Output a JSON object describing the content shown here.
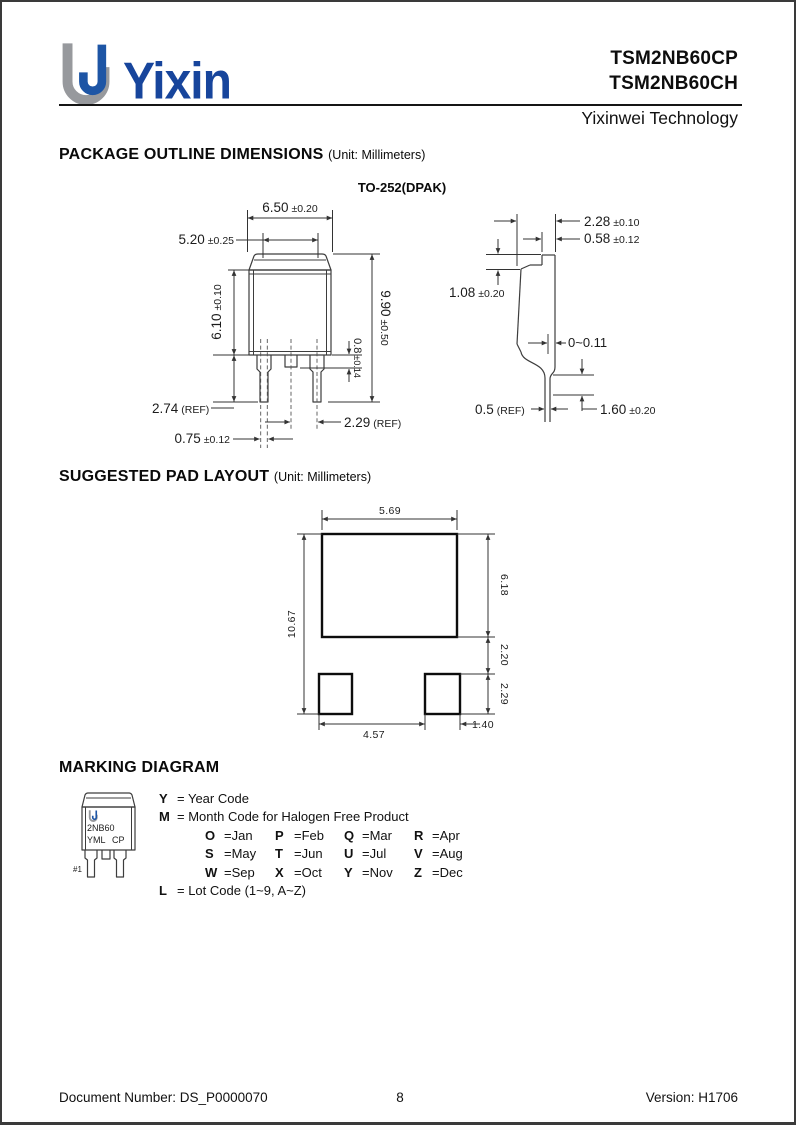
{
  "header": {
    "logo_text": "Yixin",
    "title_line1": "TSM2NB60CP",
    "title_line2": "TSM2NB60CH",
    "subtitle": "Yixinwei Technology"
  },
  "sections": {
    "package_outline_title": "PACKAGE OUTLINE DIMENSIONS",
    "package_outline_unit": "(Unit: Millimeters)",
    "package_name": "TO-252(DPAK)",
    "pad_layout_title": "SUGGESTED PAD LAYOUT",
    "pad_layout_unit": "(Unit: Millimeters)",
    "marking_title": "MARKING DIAGRAM"
  },
  "outline_dims": {
    "front": {
      "width_top": {
        "value": "6.50",
        "tol": "±0.20"
      },
      "width_inner": {
        "value": "5.20",
        "tol": "±0.25"
      },
      "body_height": {
        "value": "6.10",
        "tol": "±0.10"
      },
      "total_height": {
        "value": "9.90",
        "tol": "±0.50"
      },
      "mid_lead": {
        "value": "0.8",
        "tol": "±0.14"
      },
      "lead_length": {
        "value": "2.74",
        "ref": "(REF)"
      },
      "lead_width": {
        "value": "0.75",
        "tol": "±0.12"
      },
      "lead_pitch": {
        "value": "2.29",
        "ref": "(REF)"
      }
    },
    "side": {
      "thickness": {
        "value": "2.28",
        "tol": "±0.10"
      },
      "tab_thickness": {
        "value": "0.58",
        "tol": "±0.12"
      },
      "tab_step": {
        "value": "1.08",
        "tol": "±0.20"
      },
      "flash": {
        "value": "0~0.11"
      },
      "lead_thickness": {
        "value": "0.5",
        "ref": "(REF)"
      },
      "lead_bend": {
        "value": "1.60",
        "tol": "±0.20"
      }
    }
  },
  "pad_dims": {
    "big_pad_width": "5.69",
    "total_height": "10.67",
    "big_pad_height": "6.18",
    "gap": "2.20",
    "small_pad_height": "2.29",
    "pad_spacing": "4.57",
    "small_pad_width": "1.40"
  },
  "marking": {
    "device_line": "2NB60",
    "code_line_left": "YML",
    "code_line_right": "CP",
    "pin1_label": "#1",
    "legend": [
      {
        "code": "Y",
        "desc": "= Year Code"
      },
      {
        "code": "M",
        "desc": "= Month Code for Halogen Free Product"
      },
      {
        "code": "L",
        "desc": "= Lot Code (1~9, A~Z)"
      }
    ],
    "months": [
      [
        {
          "c": "O",
          "m": "=Jan"
        },
        {
          "c": "P",
          "m": "=Feb"
        },
        {
          "c": "Q",
          "m": "=Mar"
        },
        {
          "c": "R",
          "m": "=Apr"
        }
      ],
      [
        {
          "c": "S",
          "m": "=May"
        },
        {
          "c": "T",
          "m": "=Jun"
        },
        {
          "c": "U",
          "m": "=Jul"
        },
        {
          "c": "V",
          "m": "=Aug"
        }
      ],
      [
        {
          "c": "W",
          "m": "=Sep"
        },
        {
          "c": "X",
          "m": "=Oct"
        },
        {
          "c": "Y",
          "m": "=Nov"
        },
        {
          "c": "Z",
          "m": "=Dec"
        }
      ]
    ]
  },
  "footer": {
    "document_number": "Document Number: DS_P0000070",
    "page": "8",
    "version": "Version: H1706"
  },
  "colors": {
    "logo_blue": "#17459c",
    "logo_gray": "#97999d",
    "line_dark": "#3d3d3d"
  }
}
